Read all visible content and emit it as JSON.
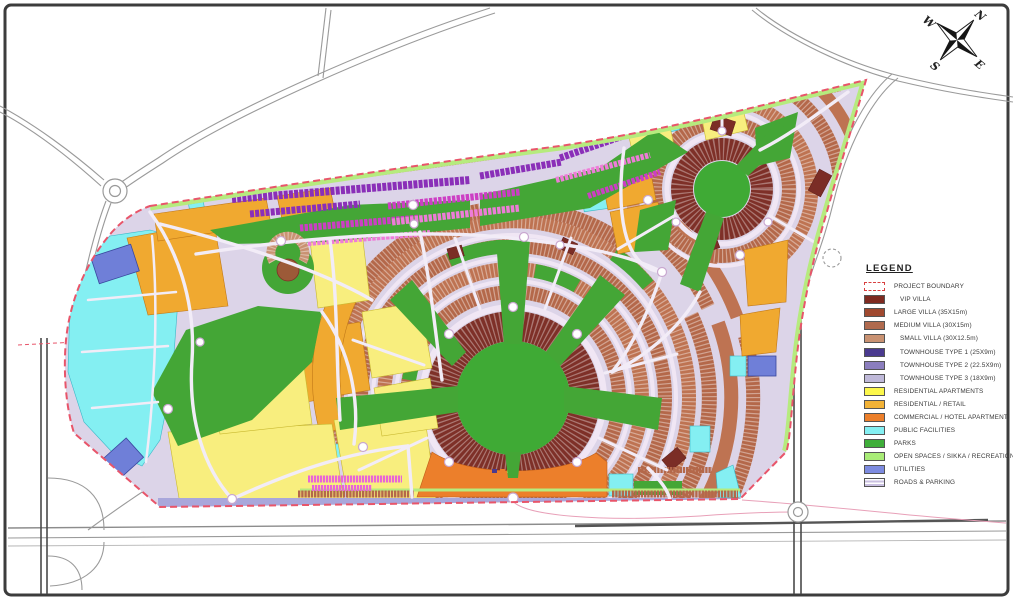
{
  "compass": {
    "n": "N",
    "e": "E",
    "s": "S",
    "w": "W"
  },
  "legend": {
    "title": "LEGEND",
    "items": [
      {
        "label": "PROJECT BOUNDARY",
        "fill": "#FFFFFF",
        "border": "#D84040",
        "pattern": "dashed-box"
      },
      {
        "label": "VIP VILLA",
        "fill": "#7E2A20",
        "indent": true
      },
      {
        "label": "LARGE VILLA (35X15m)",
        "fill": "#A0492F"
      },
      {
        "label": "MEDIUM VILLA (30X15m)",
        "fill": "#B06A4E"
      },
      {
        "label": "SMALL VILLA (30X12.5m)",
        "fill": "#C99272",
        "indent": true
      },
      {
        "label": "TOWNHOUSE TYPE 1 (25X9m)",
        "fill": "#4A3A8F",
        "indent": true
      },
      {
        "label": "TOWNHOUSE TYPE 2 (22.5X9m)",
        "fill": "#8B7EBE",
        "indent": true
      },
      {
        "label": "TOWNHOUSE TYPE 3 (18X9m)",
        "fill": "#BFB9D9",
        "indent": true
      },
      {
        "label": "RESIDENTIAL APARTMENTS",
        "fill": "#FCF74B"
      },
      {
        "label": "RESIDENTIAL / RETAIL",
        "fill": "#F2B236"
      },
      {
        "label": "COMMERCIAL / HOTEL APARTMENT",
        "fill": "#EC7F2B"
      },
      {
        "label": "PUBLIC FACILITIES",
        "fill": "#84EFF2"
      },
      {
        "label": "PARKS",
        "fill": "#3FAE3A"
      },
      {
        "label": "OPEN SPACES / SIKKA / RECREATION",
        "fill": "#A9EC77"
      },
      {
        "label": "UTILITIES",
        "fill": "#7D8BE0"
      },
      {
        "label": "ROADS & PARKING",
        "fill": "#C9BFE0",
        "pattern": "stripes"
      }
    ]
  },
  "map": {
    "colors": {
      "boundary_dash": "#E8556A",
      "vip_villa": "#7E3028",
      "large_villa": "#B4684A",
      "medium_villa": "#BE7352",
      "small_villa": "#C99272",
      "townhouse_1": "#8A2FB8",
      "townhouse_2": "#CC3FC4",
      "townhouse_3": "#EE7CD8",
      "residential_apartments": "#F8EE7E",
      "residential_retail": "#F0A930",
      "commercial_hotel": "#EC7F2B",
      "public_facilities": "#84EFF2",
      "parks": "#44A636",
      "open_spaces": "#B6EB7E",
      "utilities": "#7D8BE0",
      "roads_parking": "#DCD4E8",
      "highway": "#9A9A9A"
    }
  }
}
